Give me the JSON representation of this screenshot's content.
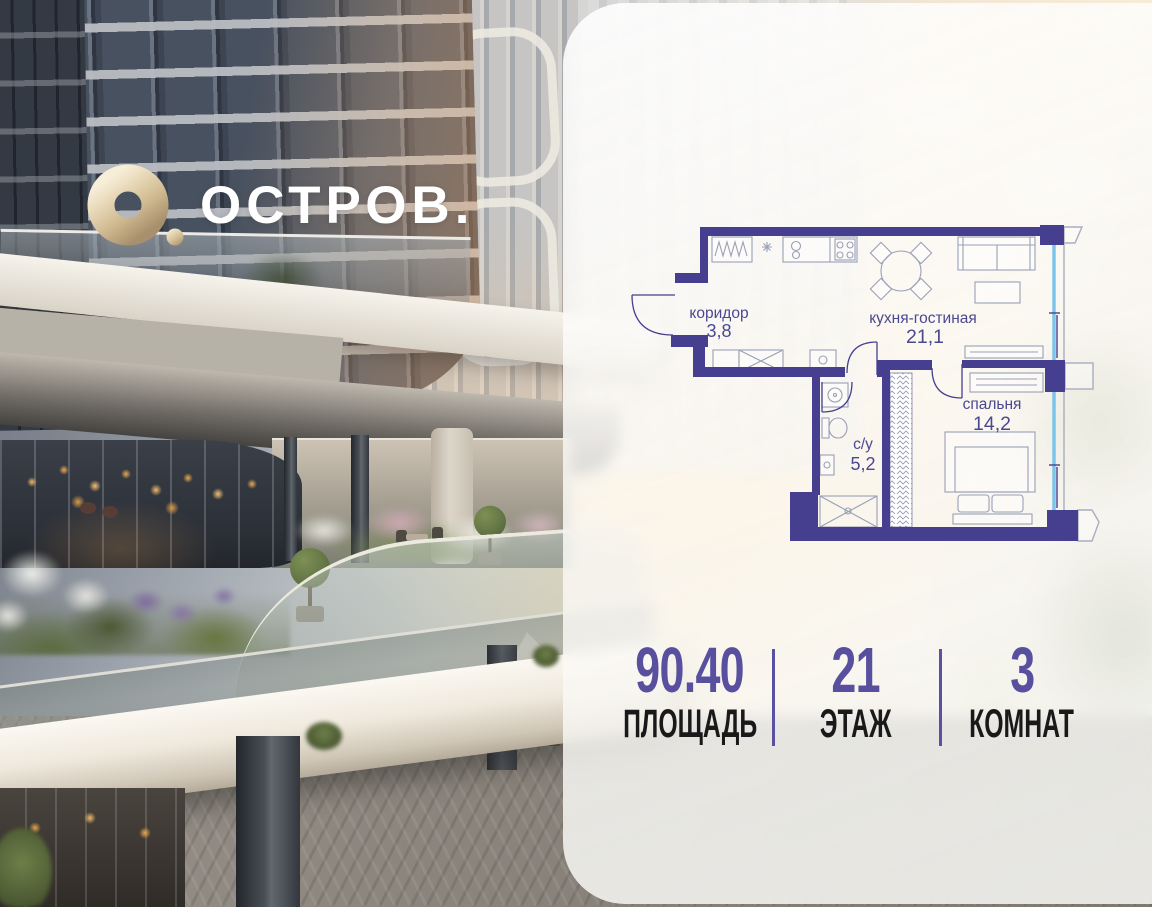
{
  "logo": {
    "wordmark": "ОСТРОВ."
  },
  "floor_plan": {
    "rooms": [
      {
        "name": "коридор",
        "area": "3,8"
      },
      {
        "name": "кухня-гостиная",
        "area": "21,1"
      },
      {
        "name": "с/у",
        "area": "5,2"
      },
      {
        "name": "спальня",
        "area": "14,2"
      }
    ]
  },
  "stats": {
    "items": [
      {
        "value": "90.40",
        "label": "ПЛОЩАДЬ"
      },
      {
        "value": "21",
        "label": "ЭТАЖ"
      },
      {
        "value": "3",
        "label": "КОМНАТ"
      }
    ]
  },
  "colors": {
    "accent_purple": "#584f9e",
    "plan_wall": "#463f8f",
    "plan_window_blue": "#7cc5e9",
    "logo_gold": "#d6c3a1"
  }
}
